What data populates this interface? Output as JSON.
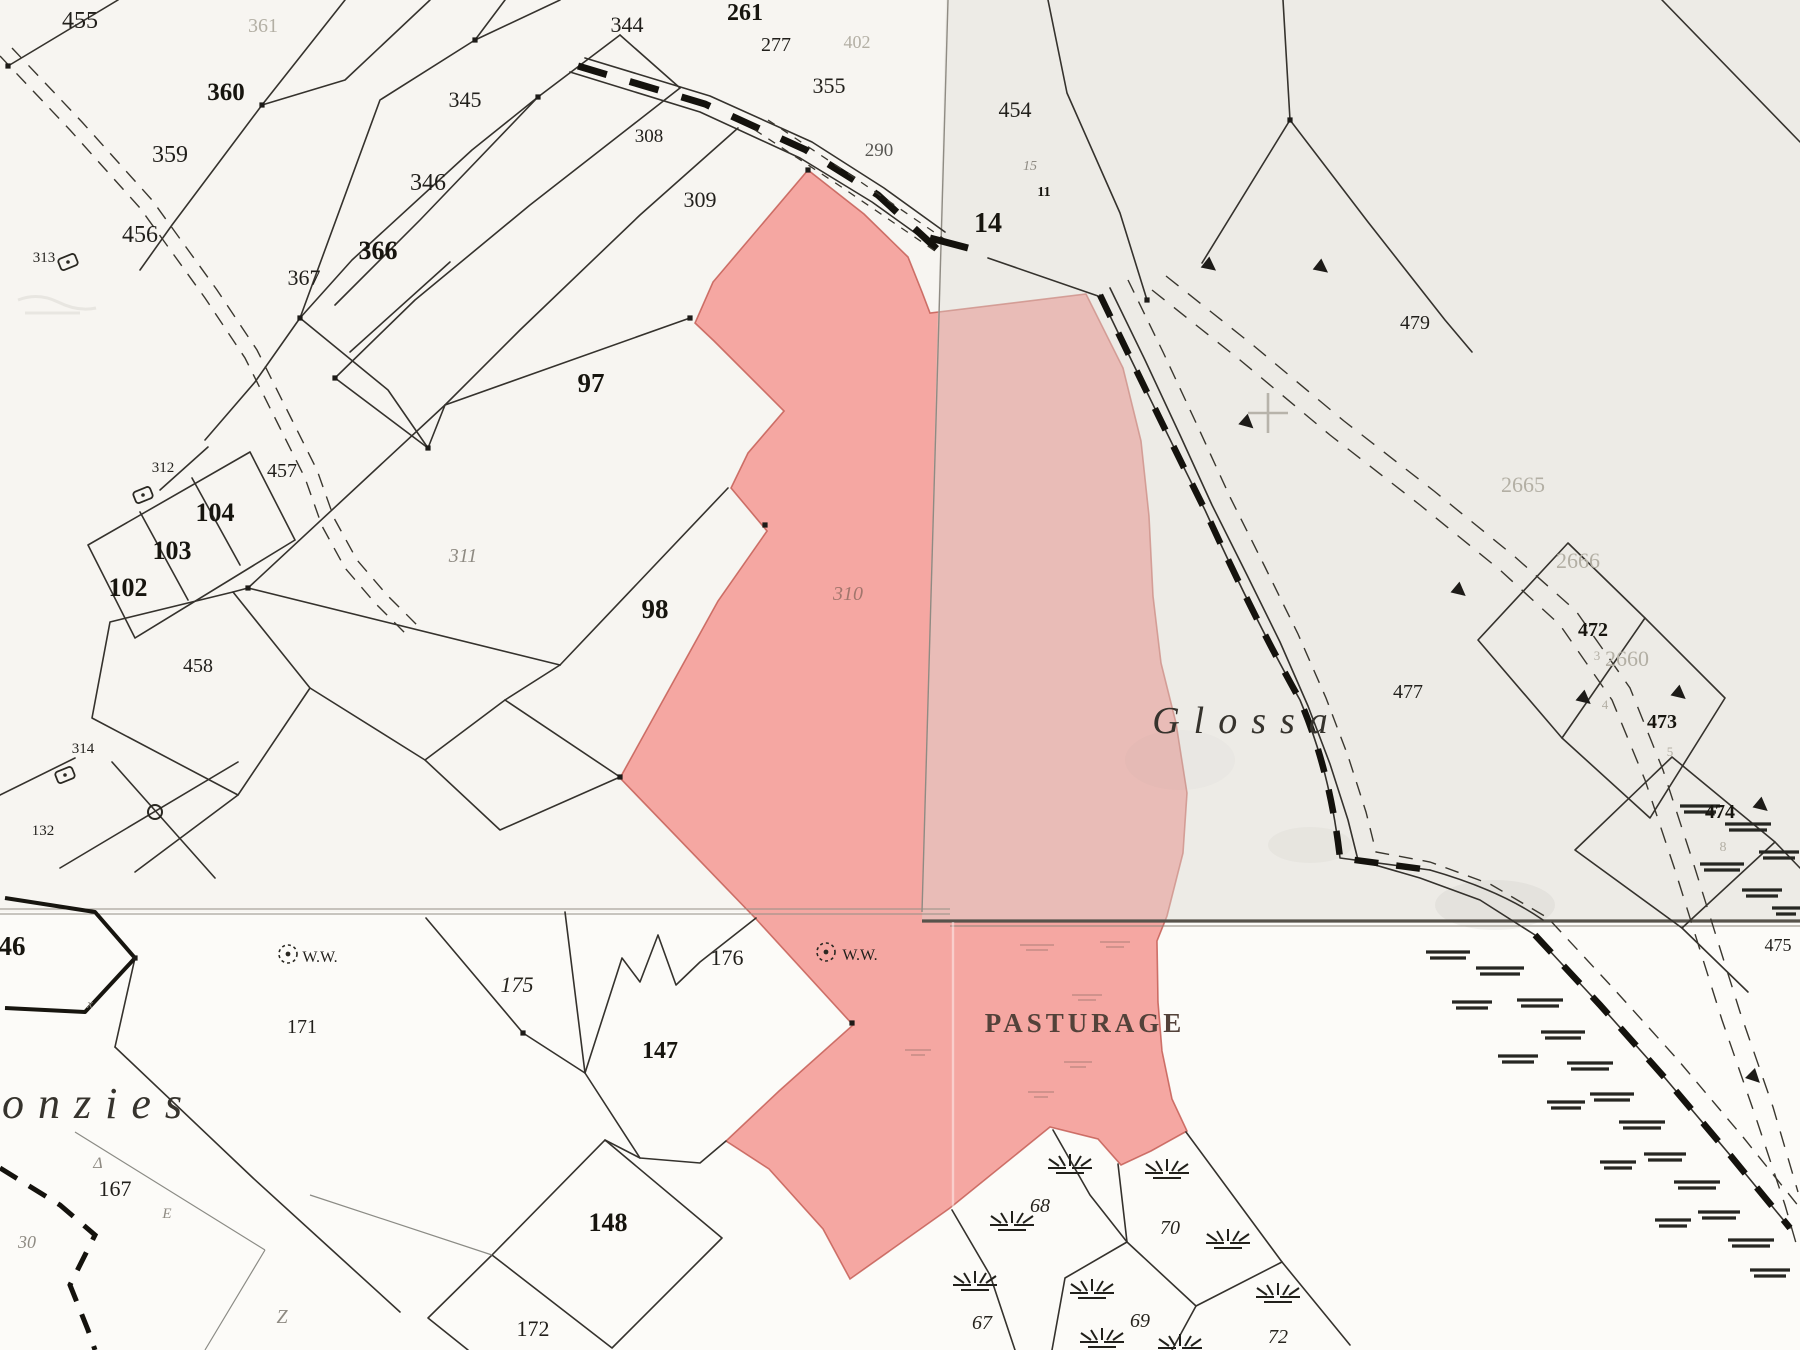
{
  "colors": {
    "paper": "#fcfbf8",
    "highlight_pink": "#f5a7a2",
    "pink_edge": "#c2574f",
    "sheet_tint": "#dbd7d0",
    "ink": "#35322d",
    "faint_ink": "#b3afa4"
  },
  "place_names": [
    "Glossa",
    "onzies"
  ],
  "land_use_label": "PASTURAGE",
  "well_label": "W.W.",
  "highlighted_parcel": "310",
  "labels": [
    {
      "t": "455",
      "x": 80,
      "y": 28,
      "s": 24,
      "c": "n"
    },
    {
      "t": "361",
      "x": 263,
      "y": 32,
      "s": 20,
      "c": "f"
    },
    {
      "t": "360",
      "x": 226,
      "y": 100,
      "s": 25,
      "c": "nb"
    },
    {
      "t": "359",
      "x": 170,
      "y": 162,
      "s": 24,
      "c": "n"
    },
    {
      "t": "456",
      "x": 140,
      "y": 242,
      "s": 24,
      "c": "n"
    },
    {
      "t": "313",
      "x": 44,
      "y": 262,
      "s": 15,
      "c": "n"
    },
    {
      "t": "366",
      "x": 378,
      "y": 259,
      "s": 26,
      "c": "nb"
    },
    {
      "t": "367",
      "x": 304,
      "y": 285,
      "s": 22,
      "c": "n"
    },
    {
      "t": "346",
      "x": 428,
      "y": 190,
      "s": 24,
      "c": "n"
    },
    {
      "t": "345",
      "x": 465,
      "y": 107,
      "s": 22,
      "c": "n"
    },
    {
      "t": "344",
      "x": 627,
      "y": 32,
      "s": 22,
      "c": "n"
    },
    {
      "t": "308",
      "x": 649,
      "y": 142,
      "s": 19,
      "c": "n"
    },
    {
      "t": "309",
      "x": 700,
      "y": 207,
      "s": 22,
      "c": "n"
    },
    {
      "t": "261",
      "x": 745,
      "y": 20,
      "s": 24,
      "c": "nb"
    },
    {
      "t": "277",
      "x": 776,
      "y": 51,
      "s": 20,
      "c": "n"
    },
    {
      "t": "402",
      "x": 857,
      "y": 48,
      "s": 18,
      "c": "f"
    },
    {
      "t": "355",
      "x": 829,
      "y": 93,
      "s": 22,
      "c": "n"
    },
    {
      "t": "290",
      "x": 879,
      "y": 156,
      "s": 19,
      "c": "n"
    },
    {
      "t": "454",
      "x": 1015,
      "y": 117,
      "s": 22,
      "c": "n"
    },
    {
      "t": "14",
      "x": 988,
      "y": 232,
      "s": 28,
      "c": "nb"
    },
    {
      "t": "11",
      "x": 1044,
      "y": 196,
      "s": 14,
      "c": "nb"
    },
    {
      "t": "15",
      "x": 1030,
      "y": 170,
      "s": 14,
      "c": "g"
    },
    {
      "t": "479",
      "x": 1415,
      "y": 329,
      "s": 20,
      "c": "n"
    },
    {
      "t": "97",
      "x": 591,
      "y": 392,
      "s": 27,
      "c": "nb"
    },
    {
      "t": "311",
      "x": 463,
      "y": 562,
      "s": 20,
      "c": "g"
    },
    {
      "t": "98",
      "x": 655,
      "y": 618,
      "s": 27,
      "c": "nb"
    },
    {
      "t": "310",
      "x": 848,
      "y": 600,
      "s": 20,
      "c": "gr"
    },
    {
      "t": "104",
      "x": 215,
      "y": 521,
      "s": 26,
      "c": "nb"
    },
    {
      "t": "103",
      "x": 172,
      "y": 559,
      "s": 26,
      "c": "nb"
    },
    {
      "t": "102",
      "x": 128,
      "y": 596,
      "s": 26,
      "c": "nb"
    },
    {
      "t": "457",
      "x": 282,
      "y": 477,
      "s": 20,
      "c": "n"
    },
    {
      "t": "312",
      "x": 163,
      "y": 472,
      "s": 15,
      "c": "n"
    },
    {
      "t": "458",
      "x": 198,
      "y": 672,
      "s": 20,
      "c": "n"
    },
    {
      "t": "314",
      "x": 83,
      "y": 753,
      "s": 15,
      "c": "n"
    },
    {
      "t": "132",
      "x": 43,
      "y": 835,
      "s": 15,
      "c": "n"
    },
    {
      "t": "46",
      "x": 12,
      "y": 955,
      "s": 27,
      "c": "nb"
    },
    {
      "t": "W.W.",
      "x": 320,
      "y": 962,
      "s": 16,
      "c": "n"
    },
    {
      "t": "W.W.",
      "x": 860,
      "y": 960,
      "s": 16,
      "c": "n"
    },
    {
      "t": "171",
      "x": 302,
      "y": 1033,
      "s": 20,
      "c": "n"
    },
    {
      "t": "175",
      "x": 517,
      "y": 992,
      "s": 22,
      "c": "ni"
    },
    {
      "t": "176",
      "x": 727,
      "y": 965,
      "s": 22,
      "c": "n"
    },
    {
      "t": "147",
      "x": 660,
      "y": 1058,
      "s": 24,
      "c": "nb"
    },
    {
      "t": "148",
      "x": 608,
      "y": 1231,
      "s": 26,
      "c": "nb"
    },
    {
      "t": "172",
      "x": 533,
      "y": 1336,
      "s": 22,
      "c": "n"
    },
    {
      "t": "167",
      "x": 115,
      "y": 1196,
      "s": 22,
      "c": "n"
    },
    {
      "t": "30",
      "x": 27,
      "y": 1248,
      "s": 18,
      "c": "g"
    },
    {
      "t": "onzies",
      "x": 2,
      "y": 1118,
      "s": 44,
      "c": "gi",
      "a": "start",
      "ls": 14
    },
    {
      "t": "Δ",
      "x": 98,
      "y": 1168,
      "s": 16,
      "c": "g"
    },
    {
      "t": "E",
      "x": 167,
      "y": 1218,
      "s": 15,
      "c": "g"
    },
    {
      "t": "Z",
      "x": 282,
      "y": 1323,
      "s": 20,
      "c": "g"
    },
    {
      "t": "x",
      "x": 90,
      "y": 1008,
      "s": 13,
      "c": "g"
    },
    {
      "t": "PASTURAGE",
      "x": 1085,
      "y": 1032,
      "s": 27,
      "c": "cap",
      "ls": 4
    },
    {
      "t": "Glossa",
      "x": 1247,
      "y": 733,
      "s": 38,
      "c": "gi",
      "ls": 14
    },
    {
      "t": "477",
      "x": 1408,
      "y": 698,
      "s": 20,
      "c": "n"
    },
    {
      "t": "2665",
      "x": 1523,
      "y": 492,
      "s": 22,
      "c": "f"
    },
    {
      "t": "2666",
      "x": 1578,
      "y": 568,
      "s": 22,
      "c": "f"
    },
    {
      "t": "2660",
      "x": 1627,
      "y": 666,
      "s": 22,
      "c": "f"
    },
    {
      "t": "472",
      "x": 1593,
      "y": 636,
      "s": 20,
      "c": "nb"
    },
    {
      "t": "3",
      "x": 1597,
      "y": 660,
      "s": 13,
      "c": "f"
    },
    {
      "t": "473",
      "x": 1662,
      "y": 728,
      "s": 20,
      "c": "nb"
    },
    {
      "t": "4",
      "x": 1605,
      "y": 709,
      "s": 13,
      "c": "f"
    },
    {
      "t": "5",
      "x": 1670,
      "y": 756,
      "s": 13,
      "c": "f"
    },
    {
      "t": "474",
      "x": 1720,
      "y": 818,
      "s": 20,
      "c": "nb"
    },
    {
      "t": "8",
      "x": 1723,
      "y": 851,
      "s": 14,
      "c": "f"
    },
    {
      "t": "475",
      "x": 1778,
      "y": 951,
      "s": 18,
      "c": "n"
    },
    {
      "t": "68",
      "x": 1040,
      "y": 1212,
      "s": 20,
      "c": "ni"
    },
    {
      "t": "70",
      "x": 1170,
      "y": 1234,
      "s": 20,
      "c": "ni"
    },
    {
      "t": "67",
      "x": 982,
      "y": 1329,
      "s": 20,
      "c": "ni"
    },
    {
      "t": "69",
      "x": 1140,
      "y": 1327,
      "s": 20,
      "c": "ni"
    },
    {
      "t": "72",
      "x": 1278,
      "y": 1343,
      "s": 20,
      "c": "ni"
    }
  ],
  "symbols": [
    {
      "name": "well-symbol",
      "x": 288,
      "y": 954
    },
    {
      "name": "well-symbol",
      "x": 826,
      "y": 952
    },
    {
      "name": "boundary-ring-symbol",
      "x": 155,
      "y": 812
    },
    {
      "name": "tag-marker-symbol",
      "x": 68,
      "y": 262
    },
    {
      "name": "tag-marker-symbol",
      "x": 143,
      "y": 495
    },
    {
      "name": "tag-marker-symbol",
      "x": 65,
      "y": 775
    },
    {
      "name": "survey-cross-symbol",
      "x": 1268,
      "y": 413
    }
  ],
  "tussocks": [
    [
      1070,
      1168
    ],
    [
      1012,
      1225
    ],
    [
      1167,
      1173
    ],
    [
      1228,
      1243
    ],
    [
      975,
      1285
    ],
    [
      1092,
      1293
    ],
    [
      1278,
      1297
    ],
    [
      1102,
      1342
    ],
    [
      1180,
      1348
    ]
  ],
  "arrows": [
    [
      1205,
      262,
      38
    ],
    [
      1317,
      264,
      38
    ],
    [
      1243,
      419,
      42
    ],
    [
      1455,
      587,
      40
    ],
    [
      1580,
      695,
      40
    ],
    [
      1675,
      690,
      40
    ],
    [
      1757,
      802,
      40
    ],
    [
      1750,
      1073,
      45
    ]
  ],
  "dots": [
    [
      8,
      66
    ],
    [
      262,
      105
    ],
    [
      475,
      40
    ],
    [
      538,
      97
    ],
    [
      300,
      318
    ],
    [
      335,
      378
    ],
    [
      428,
      448
    ],
    [
      248,
      588
    ],
    [
      523,
      1033
    ],
    [
      135,
      958
    ],
    [
      1147,
      300
    ],
    [
      1290,
      120
    ],
    [
      690,
      318
    ],
    [
      765,
      525
    ],
    [
      620,
      777
    ],
    [
      808,
      170
    ],
    [
      852,
      1023
    ]
  ]
}
